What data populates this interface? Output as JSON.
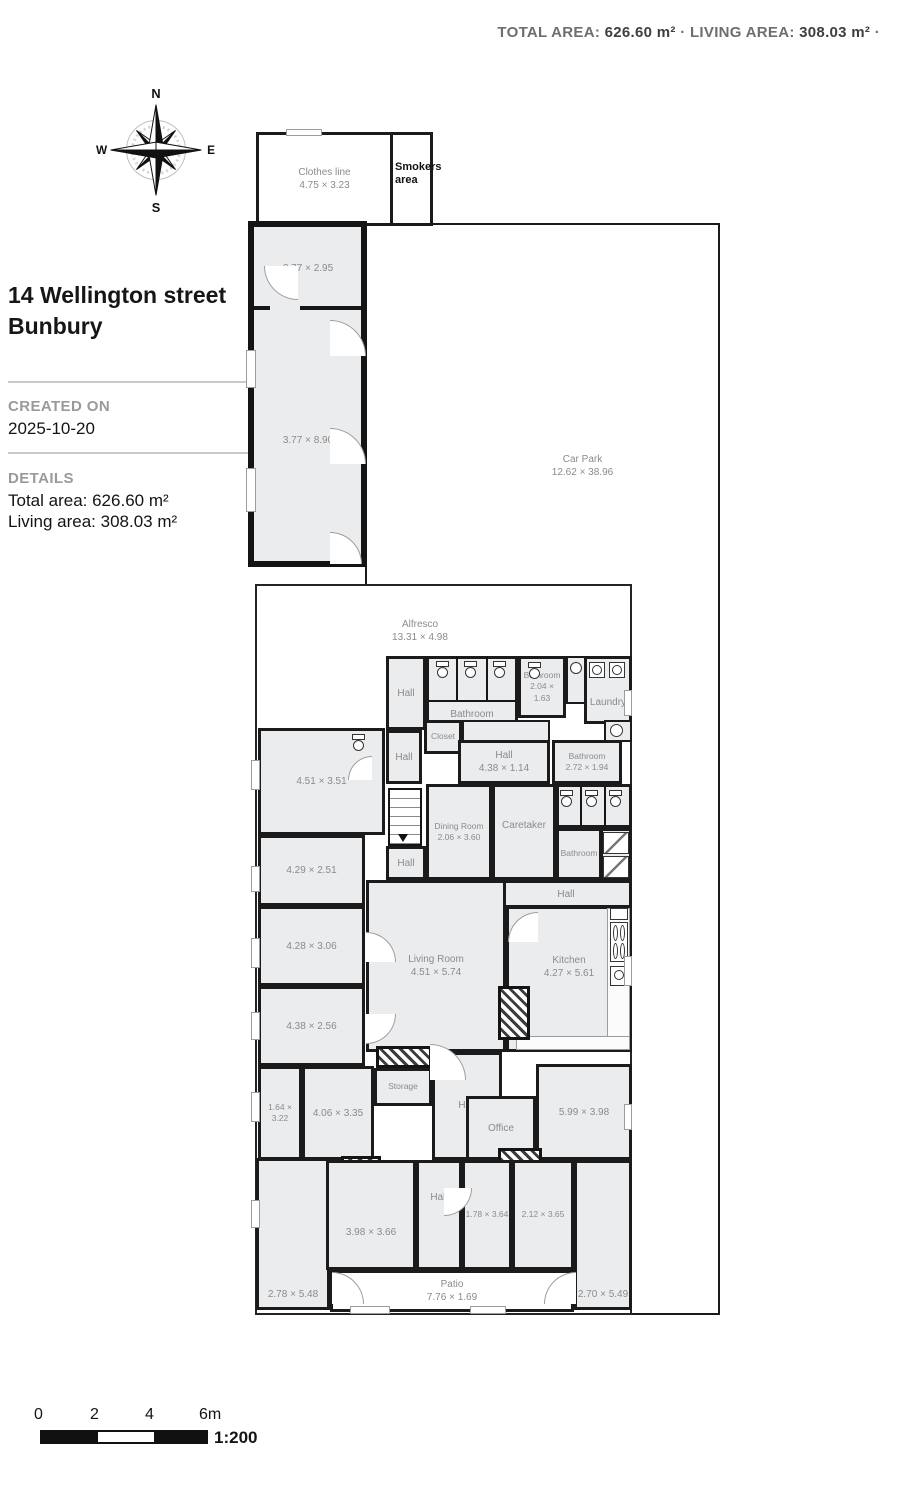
{
  "header": {
    "total_area_label": "TOTAL AREA:",
    "total_area_value": "626.60 m²",
    "separator": "·",
    "living_area_label": "LIVING AREA:",
    "living_area_value": "308.03 m²",
    "trailing_separator": "·"
  },
  "compass": {
    "north": "N",
    "east": "E",
    "south": "S",
    "west": "W"
  },
  "info_panel": {
    "address_line1": "14 Wellington street",
    "address_line2": "Bunbury",
    "created_on_label": "CREATED ON",
    "created_on_value": "2025-10-20",
    "details_label": "DETAILS",
    "total_area_text": "Total area: 626.60 m²",
    "living_area_text": "Living area: 308.03 m²"
  },
  "scale_bar": {
    "ticks": [
      "0",
      "2",
      "4",
      "6m"
    ],
    "ratio": "1:200"
  },
  "rooms": {
    "clothes_line": {
      "name": "Clothes line",
      "dims": "4.75 × 3.23"
    },
    "smokers_area": {
      "name": "Smokers area"
    },
    "bed_377_295": {
      "dims": "3.77 × 2.95"
    },
    "bed_377_890": {
      "dims": "3.77 × 8.90"
    },
    "car_park": {
      "name": "Car Park",
      "dims": "12.62 × 38.96"
    },
    "alfresco": {
      "name": "Alfresco",
      "dims": "13.31 × 4.98"
    },
    "hall_top": {
      "name": "Hall"
    },
    "bathroom_top": {
      "name": "Bathroom"
    },
    "bathroom_204": {
      "name": "Bathroom",
      "dims": "2.04 × 1.63"
    },
    "laundry": {
      "name": "Laundry"
    },
    "toilet": {
      "name": "Toilet"
    },
    "closet": {
      "name": "Closet"
    },
    "hall_mid": {
      "name": "Hall"
    },
    "hall_438": {
      "name": "Hall",
      "dims": "4.38 × 1.14"
    },
    "bathroom_272": {
      "name": "Bathroom",
      "dims": "2.72 × 1.94"
    },
    "room_451_351": {
      "dims": "4.51 × 3.51"
    },
    "dining_room": {
      "name": "Dining Room",
      "dims": "2.06 × 3.60"
    },
    "caretaker": {
      "name": "Caretaker"
    },
    "bathroom_mid": {
      "name": "Bathroom"
    },
    "hall_stairs": {
      "name": "Hall"
    },
    "room_429_251": {
      "dims": "4.29 × 2.51"
    },
    "hall_kitchen": {
      "name": "Hall"
    },
    "room_428_306": {
      "dims": "4.28 × 3.06"
    },
    "living_room": {
      "name": "Living Room",
      "dims": "4.51 × 5.74"
    },
    "kitchen": {
      "name": "Kitchen",
      "dims": "4.27 × 5.61"
    },
    "room_438_256": {
      "dims": "4.38 × 2.56"
    },
    "storage": {
      "name": "Storage"
    },
    "hall_center": {
      "name": "Hall"
    },
    "room_599_398": {
      "dims": "5.99 × 3.98"
    },
    "room_164_322": {
      "dims": "1.64 × 3.22"
    },
    "room_406_335": {
      "dims": "4.06 × 3.35"
    },
    "office": {
      "name": "Office"
    },
    "hall_bottom": {
      "name": "Hall"
    },
    "room_398_366": {
      "dims": "3.98 × 3.66"
    },
    "room_178_364": {
      "dims": "1.78 × 3.64"
    },
    "room_212_365": {
      "dims": "2.12 × 3.65"
    },
    "patio": {
      "name": "Patio",
      "dims": "7.76 × 1.69"
    },
    "room_278_548": {
      "dims": "2.78 × 5.48"
    },
    "room_270_549": {
      "dims": "2.70 × 5.49"
    }
  },
  "icons": {
    "compass_rose": "8-point star",
    "toilet": "tank + bowl shape",
    "shower": "diagonal-line square",
    "basin": "circle in box",
    "washer": "circle in box",
    "stove": "four burner circles",
    "stairs": "tread lines with arrow",
    "chimney": "diagonal hatch block"
  }
}
